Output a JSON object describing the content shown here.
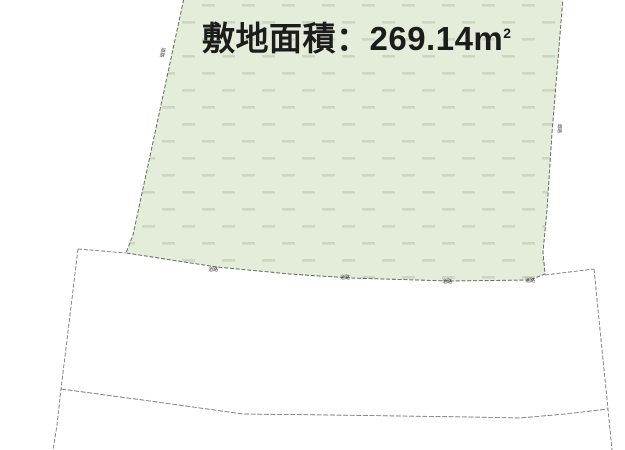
{
  "site": {
    "area_label": "敷地面積：269.14m",
    "area_sup": "2"
  },
  "road_labels": [
    "道路",
    "道路",
    "道路",
    "道路"
  ],
  "edge_labels": {
    "left": "道路",
    "right": "道路"
  },
  "colors": {
    "parcel_fill": "#e4edda",
    "parcel_hatch": "#cbd7bf",
    "parcel_outline": "#5f5f55",
    "road_line": "#6f6f6f",
    "label_color": "#3f3f3f",
    "title_color": "#1c1c1c",
    "background": "#ffffff"
  }
}
